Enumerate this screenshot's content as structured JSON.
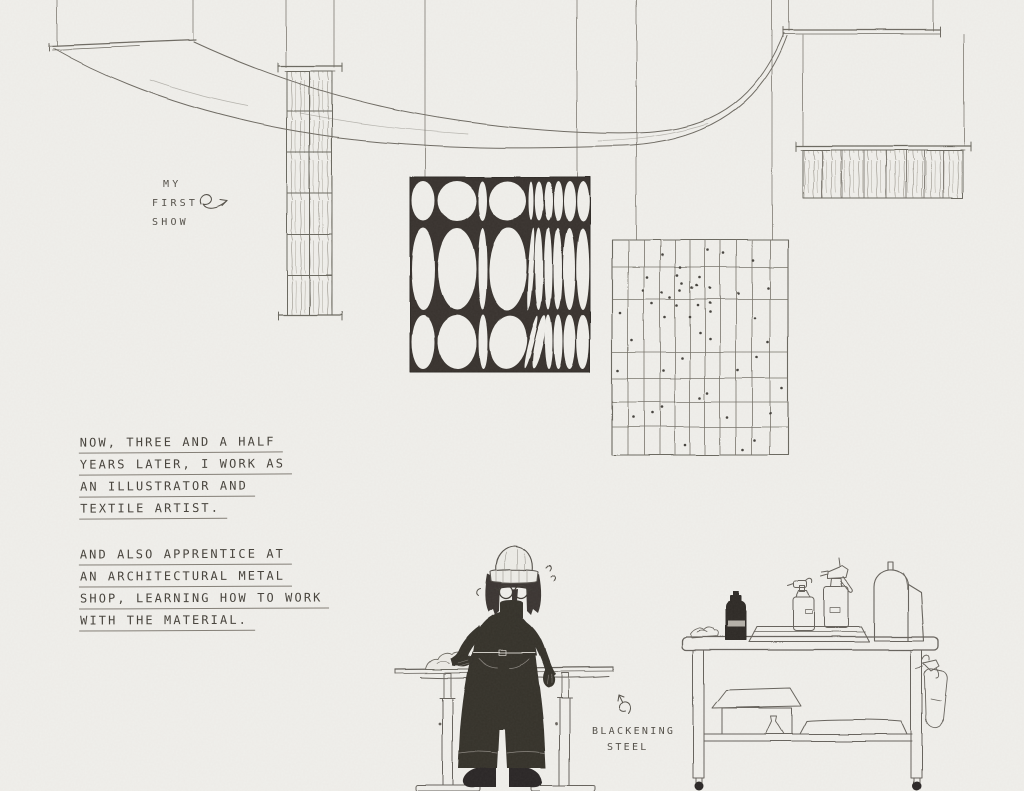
{
  "colors": {
    "paper": "#f0efeb",
    "pencil_ink": "#5e5a53",
    "pencil_light": "#8d8981",
    "dark_fill": "#34302b",
    "text_ink": "#49453e"
  },
  "labels": {
    "first_show": {
      "lines": [
        "MY",
        "FIRST",
        "SHOW"
      ]
    },
    "career_note": {
      "lines": [
        "NOW, THREE AND A HALF",
        "YEARS LATER, I WORK AS",
        "AN ILLUSTRATOR AND",
        "TEXTILE ARTIST."
      ]
    },
    "apprentice_note": {
      "lines": [
        "AND ALSO APPRENTICE AT",
        "AN ARCHITECTURAL METAL",
        "SHOP, LEARNING HOW TO WORK",
        "WITH THE MATERIAL."
      ]
    },
    "blackening_steel": {
      "lines": [
        "BLACKENING",
        "STEEL"
      ]
    }
  },
  "scene": {
    "elements": [
      "ceiling-wires",
      "draped-sheer-textile",
      "woven-column-banner",
      "oval-pattern-textile",
      "grid-dot-textile",
      "fringe-textile",
      "artist-figure",
      "adjustable-work-table",
      "metal-shop-cart"
    ]
  }
}
